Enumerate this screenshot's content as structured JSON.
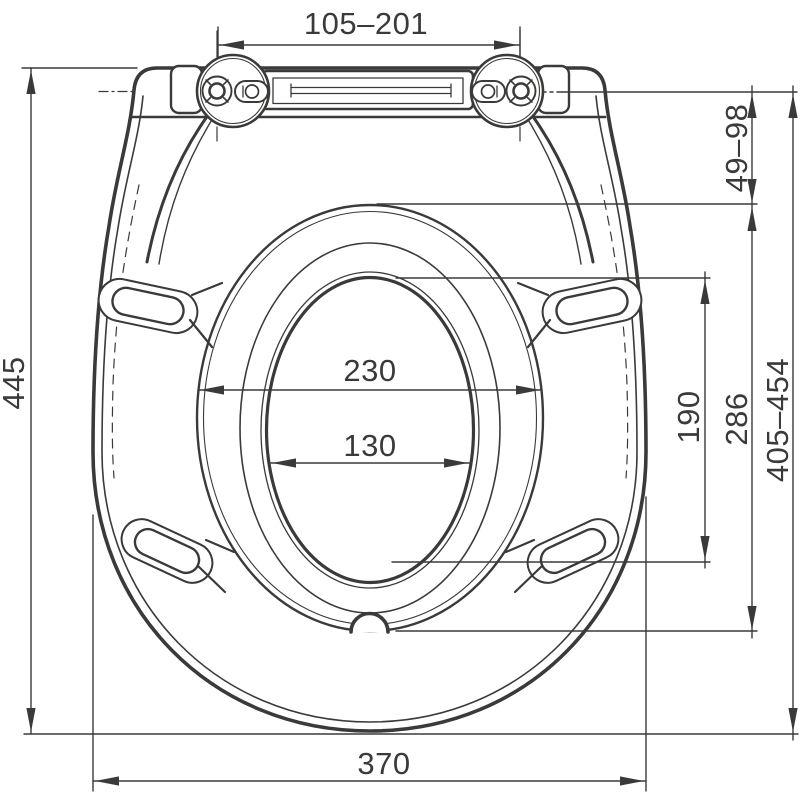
{
  "drawing": {
    "type": "technical-dimension-drawing",
    "subject": "toilet seat with lid, top view",
    "line_color": "#3a3a38",
    "background_color": "#ffffff",
    "dims": {
      "hinge_pin_spacing": "105–201",
      "hinge_axis_to_recess": "49–98",
      "total_length": "445",
      "recess_width": "230",
      "opening_width": "130",
      "opening_length": "190",
      "recess_length": "286",
      "hinge_axis_to_front": "405–454",
      "total_width": "370"
    }
  }
}
